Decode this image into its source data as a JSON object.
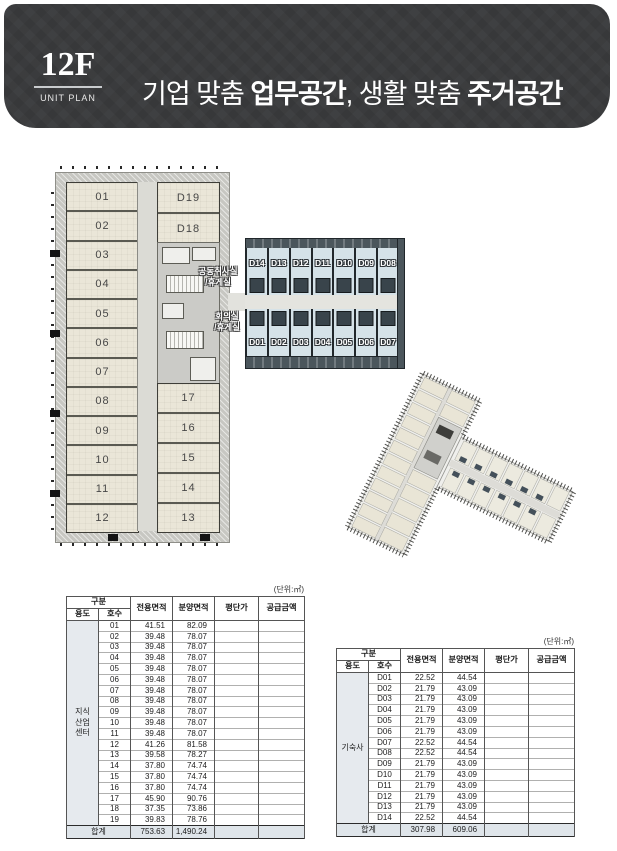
{
  "header": {
    "floor_label": "12F",
    "plan_label": "UNIT PLAN",
    "title_parts": [
      {
        "text": "기업 맞춤 ",
        "bold": false
      },
      {
        "text": "업무공간",
        "bold": true
      },
      {
        "text": ", 생활 맞춤 ",
        "bold": false
      },
      {
        "text": "주거공간",
        "bold": true
      }
    ]
  },
  "colors": {
    "header_bg": "#3a3b3d",
    "office_room": "#eae6d8",
    "dorm_room": "#d5e2e8",
    "dorm_wall": "#4b565c",
    "corridor": "#dbdbd5",
    "exterior_wall": "#c7c7c2",
    "table_tint": "#dfe5ea"
  },
  "floor_plan": {
    "office_rooms_left": [
      "01",
      "02",
      "03",
      "04",
      "05",
      "06",
      "07",
      "08",
      "09",
      "10",
      "11",
      "12"
    ],
    "office_rooms_right": [
      "17",
      "16",
      "15",
      "14",
      "13"
    ],
    "dorm_units_in_tower": [
      "D19",
      "D18"
    ],
    "dorm_row_top": [
      "D14",
      "D13",
      "D12",
      "D11",
      "D10",
      "D09",
      "D08"
    ],
    "dorm_row_bottom": [
      "D01",
      "D02",
      "D03",
      "D04",
      "D05",
      "D06",
      "D07"
    ],
    "label_common_kitchen": [
      "공동취사실",
      "/휴게실"
    ],
    "label_meeting_room": [
      "회의실",
      "/휴게실"
    ]
  },
  "tables": {
    "unit_note": "(단위:㎡)",
    "total_label": "합계",
    "headers": {
      "group": "구분",
      "usage": "용도",
      "unit_no": "호수",
      "exclusive_area": "전용면적",
      "supply_area": "분양면적",
      "price_per_pyeong": "평단가",
      "supply_amount": "공급금액"
    },
    "office": {
      "category_lines": [
        "지식",
        "산업",
        "센터"
      ],
      "rows": [
        [
          "01",
          "41.51",
          "82.09"
        ],
        [
          "02",
          "39.48",
          "78.07"
        ],
        [
          "03",
          "39.48",
          "78.07"
        ],
        [
          "04",
          "39.48",
          "78.07"
        ],
        [
          "05",
          "39.48",
          "78.07"
        ],
        [
          "06",
          "39.48",
          "78.07"
        ],
        [
          "07",
          "39.48",
          "78.07"
        ],
        [
          "08",
          "39.48",
          "78.07"
        ],
        [
          "09",
          "39.48",
          "78.07"
        ],
        [
          "10",
          "39.48",
          "78.07"
        ],
        [
          "11",
          "39.48",
          "78.07"
        ],
        [
          "12",
          "41.26",
          "81.58"
        ],
        [
          "13",
          "39.58",
          "78.27"
        ],
        [
          "14",
          "37.80",
          "74.74"
        ],
        [
          "15",
          "37.80",
          "74.74"
        ],
        [
          "16",
          "37.80",
          "74.74"
        ],
        [
          "17",
          "45.90",
          "90.76"
        ],
        [
          "18",
          "37.35",
          "73.86"
        ],
        [
          "19",
          "39.83",
          "78.76"
        ]
      ],
      "total": [
        "753.63",
        "1,490.24"
      ]
    },
    "dorm": {
      "category_lines": [
        "기숙사"
      ],
      "rows": [
        [
          "D01",
          "22.52",
          "44.54"
        ],
        [
          "D02",
          "21.79",
          "43.09"
        ],
        [
          "D03",
          "21.79",
          "43.09"
        ],
        [
          "D04",
          "21.79",
          "43.09"
        ],
        [
          "D05",
          "21.79",
          "43.09"
        ],
        [
          "D06",
          "21.79",
          "43.09"
        ],
        [
          "D07",
          "22.52",
          "44.54"
        ],
        [
          "D08",
          "22.52",
          "44.54"
        ],
        [
          "D09",
          "21.79",
          "43.09"
        ],
        [
          "D10",
          "21.79",
          "43.09"
        ],
        [
          "D11",
          "21.79",
          "43.09"
        ],
        [
          "D12",
          "21.79",
          "43.09"
        ],
        [
          "D13",
          "21.79",
          "43.09"
        ],
        [
          "D14",
          "22.52",
          "44.54"
        ]
      ],
      "total": [
        "307.98",
        "609.06"
      ]
    }
  }
}
